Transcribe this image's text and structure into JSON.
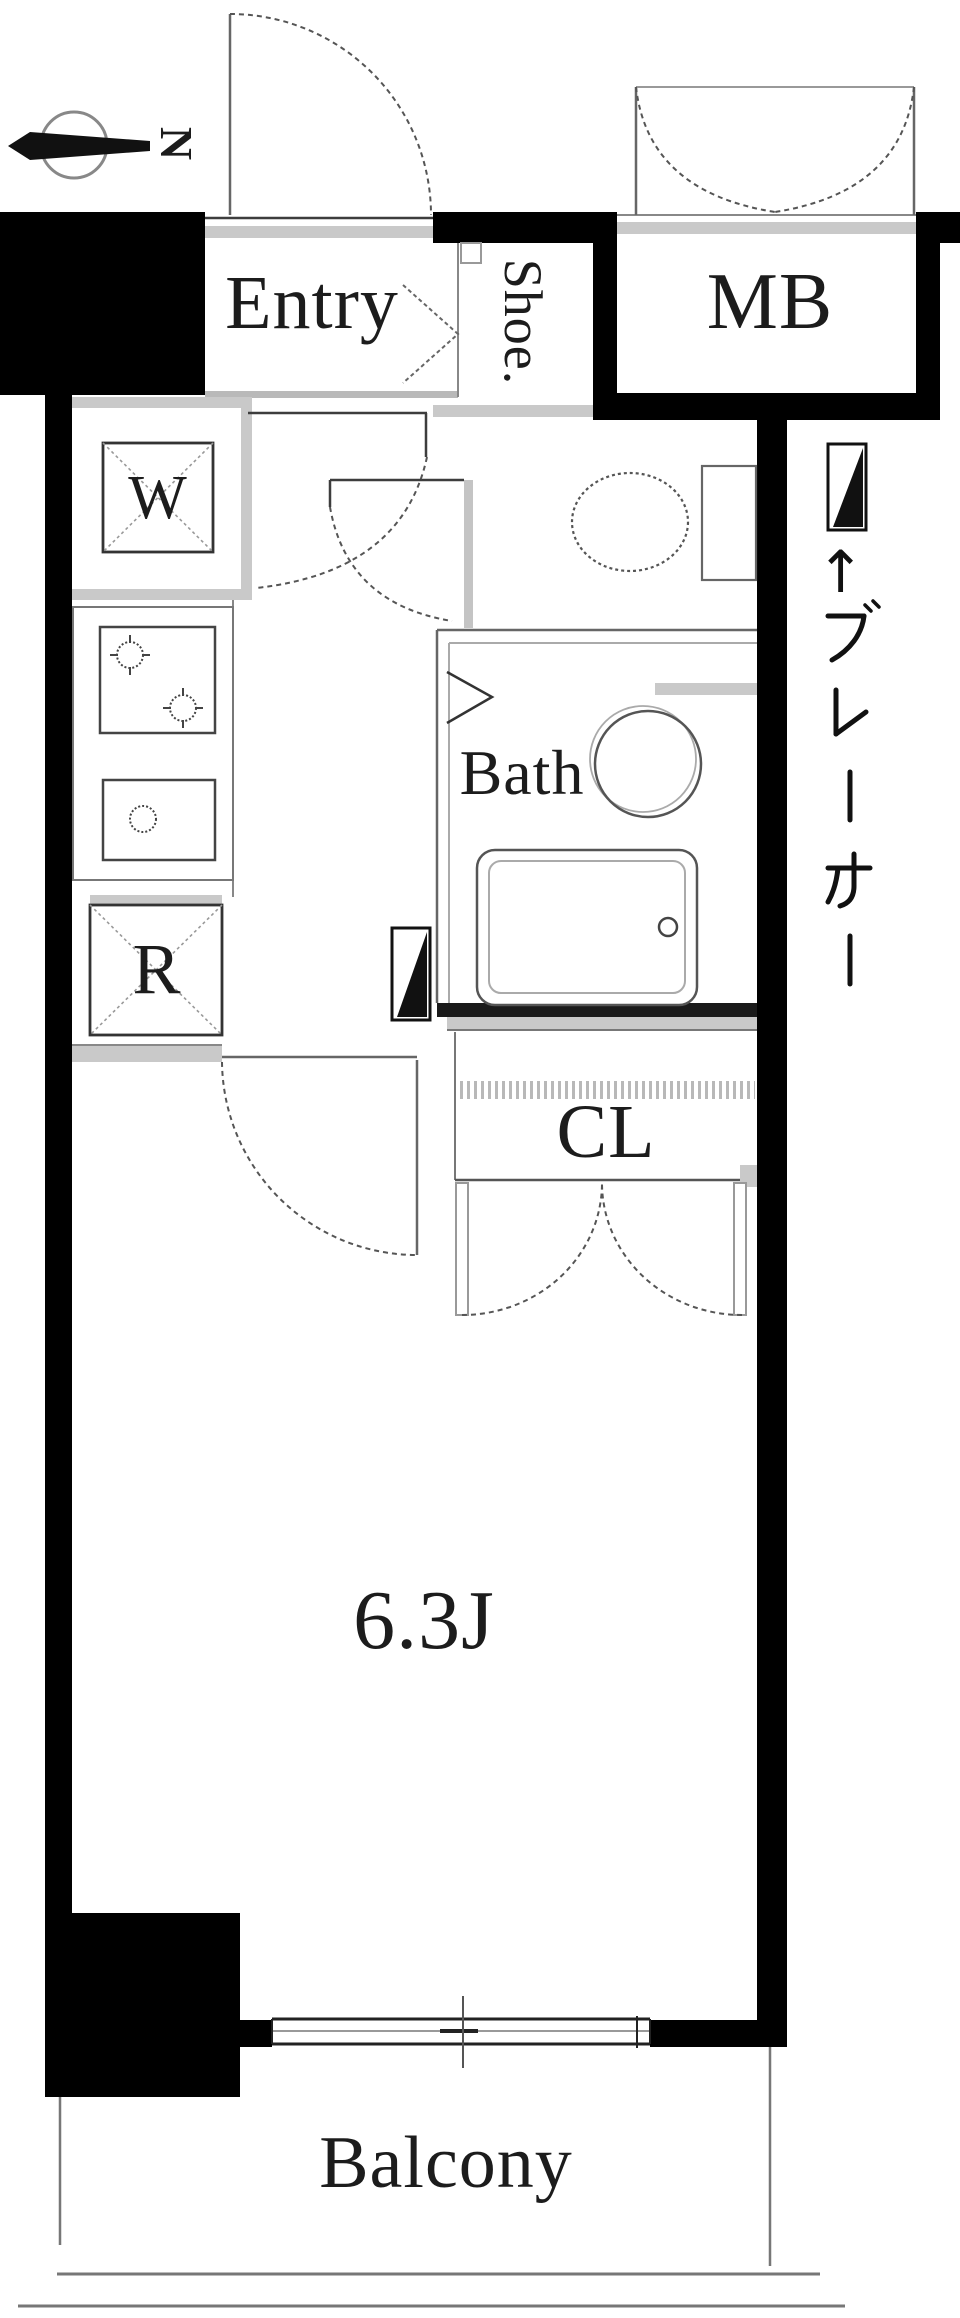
{
  "meta": {
    "type": "apartment-floor-plan",
    "style": "japanese-madori",
    "room_size_tatami": "6.3J"
  },
  "colors": {
    "background": "#ffffff",
    "wall": "#000000",
    "wall_dark": "#1a1a1a",
    "line_dark": "#3d3d3d",
    "line_mid": "#777777",
    "line_light": "#aaaaaa",
    "fill_light": "#c9c9c9",
    "text": "#1c1c1c"
  },
  "compass": {
    "label": "N"
  },
  "rooms": {
    "entry": {
      "label": "Entry"
    },
    "shoe_box": {
      "label": "Shoe."
    },
    "meter_box": {
      "label": "MB"
    },
    "bath": {
      "label": "Bath"
    },
    "closet": {
      "label": "CL"
    },
    "main_room": {
      "label": "6.3J"
    },
    "balcony": {
      "label": "Balcony"
    }
  },
  "fixtures": {
    "washer_box": {
      "label": "W"
    },
    "refrigerator_box": {
      "label": "R"
    }
  },
  "breaker": {
    "arrow": "↑",
    "label": "ブレーカー"
  }
}
